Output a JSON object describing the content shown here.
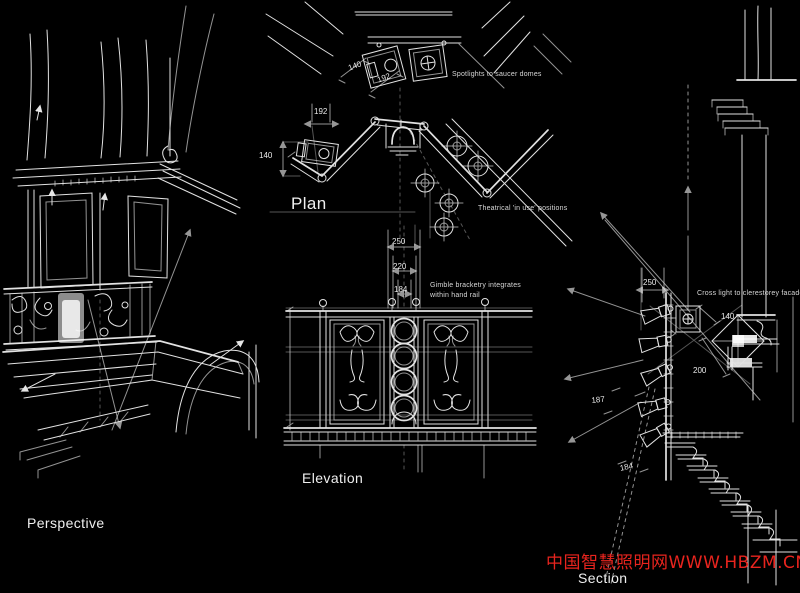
{
  "canvas": {
    "bg": "#000000",
    "ink": "#e2e2e2"
  },
  "watermark": {
    "text": "中国智慧照明网WWW.HBZM.CN",
    "color": "#e8241e"
  },
  "views": {
    "perspective": {
      "label": "Perspective"
    },
    "plan": {
      "label": "Plan",
      "note_spotlights": "Spotlights to saucer domes",
      "note_theatrical": "Theatrical 'in use' positions",
      "dim_140_top": "140",
      "dim_192_top": "192",
      "dim_192_rail": "192",
      "dim_140_rail": "140"
    },
    "elevation": {
      "label": "Elevation",
      "note_gimble_1": "Gimble bracketry integrates",
      "note_gimble_2": "within hand rail",
      "dim_250": "250",
      "dim_220": "220",
      "dim_184": "184"
    },
    "section": {
      "label": "Section",
      "note_crosslight": "Cross light to clerestorey facade",
      "dim_250": "250",
      "dim_140": "140",
      "dim_200": "200",
      "dim_187": "187",
      "dim_184": "184"
    }
  }
}
